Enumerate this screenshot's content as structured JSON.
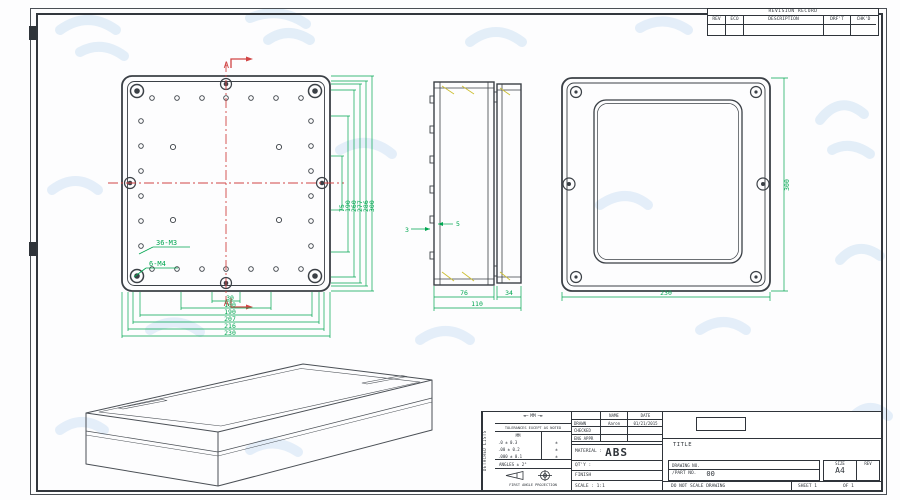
{
  "revision_table": {
    "title": "REVISION RECORD",
    "col_rev": "REV",
    "col_eco": "ECO",
    "col_description": "DESCRIPTION",
    "col_drft": "DRF'T",
    "col_chkd": "CHK'D"
  },
  "back_view": {
    "section_label": "A",
    "thread_label_small": "36-M3",
    "thread_label_large": "6-M4",
    "dims_bottom": [
      "30",
      "100",
      "190",
      "207",
      "216",
      "230"
    ],
    "dims_right": [
      "75",
      "190",
      "260",
      "277",
      "286",
      "300"
    ]
  },
  "side_view": {
    "dim_body": "76",
    "dim_lid": "34",
    "dim_total": "110",
    "wall_left": "3",
    "wall_right": "5"
  },
  "front_view": {
    "dim_width": "230",
    "dim_height": "300"
  },
  "title_block": {
    "side_strip": "DETACHED LISTS",
    "units_label": "MM",
    "tolerance_title": "TOLERANCES EXCEPT AS NOTED",
    "tol_col_header": "MM",
    "tol_rows": [
      ".0 ± 0.3",
      ".00 ± 0.2",
      ".000 ± 0.1"
    ],
    "tol_marks": [
      "±",
      "±",
      "±"
    ],
    "angles": "ANGLES ± 2°",
    "projection": "FIRST ANGLE PROJECTION",
    "name_header": "NAME",
    "date_header": "DATE",
    "drawn_label": "DRAWN",
    "drawn_name": "Aaron",
    "drawn_date": "01/21/2015",
    "checked_label": "CHECKED",
    "eng_appr_label": "ENG APPR",
    "material_label": "MATERIAL :",
    "material_value": "ABS",
    "qty_label": "QT'Y :",
    "finish_label": "FINISH",
    "scale_label": "SCALE : 1:1",
    "title_label": "TITLE",
    "drawing_no_label": "DRAWING NO.",
    "part_no_label": "/PART  NO.",
    "part_no_value": "00",
    "do_not_scale": "DO NOT SCALE DRAWING",
    "sheet_label": "SHEET 1",
    "of_label": "OF 1",
    "size_label": "SIZE",
    "size_value": "A4",
    "rev_label": "REV"
  }
}
